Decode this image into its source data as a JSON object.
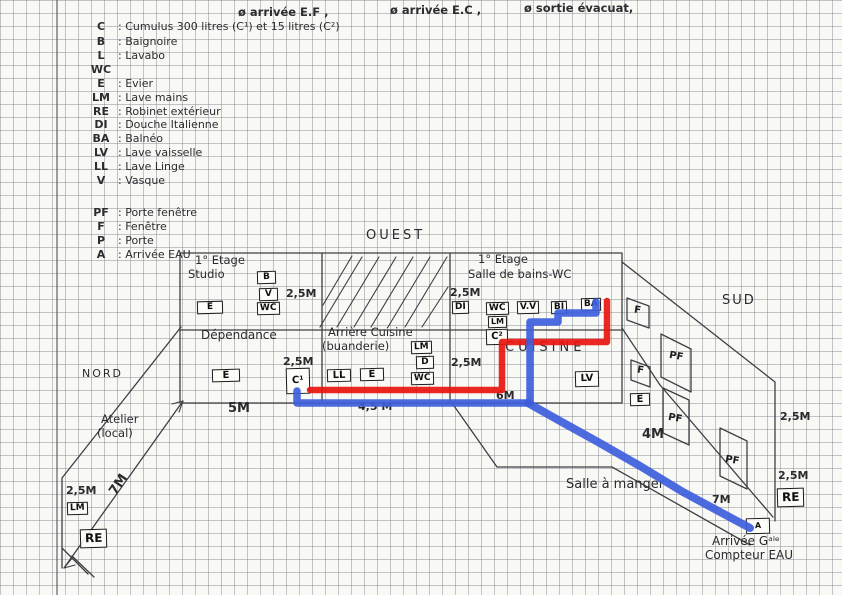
{
  "header": {
    "ef": "ø arrivée E.F ,",
    "ec": "ø arrivée E.C ,",
    "evac": "ø sortie évacuat,"
  },
  "legend": {
    "items": [
      {
        "k": "C",
        "d": ": Cumulus 300 litres (C¹) et 15 litres (C²)"
      },
      {
        "k": "B",
        "d": ": Baignoire"
      },
      {
        "k": "L",
        "d": ": Lavabo"
      },
      {
        "k": "WC",
        "d": ""
      },
      {
        "k": "E",
        "d": ": Evier"
      },
      {
        "k": "LM",
        "d": ": Lave mains"
      },
      {
        "k": "RE",
        "d": ": Robinet extérieur"
      },
      {
        "k": "DI",
        "d": ": Douche Italienne"
      },
      {
        "k": "BA",
        "d": ": Balnéo"
      },
      {
        "k": "LV",
        "d": ": Lave vaisselle"
      },
      {
        "k": "LL",
        "d": ": Lave Linge"
      },
      {
        "k": "V",
        "d": ": Vasque"
      }
    ],
    "items2": [
      {
        "k": "PF",
        "d": ": Porte fenêtre"
      },
      {
        "k": "F",
        "d": ": Fenêtre"
      },
      {
        "k": "P",
        "d": ": Porte"
      },
      {
        "k": "A",
        "d": ": Arrivée EAU"
      }
    ]
  },
  "orientation": {
    "west": "OUEST",
    "north": "NORD",
    "south": "SUD"
  },
  "rooms": {
    "studio_floor": "1° Etage",
    "studio": "Studio",
    "bath_floor": "1° Etage",
    "bath": "Salle de bains-WC",
    "dependance": "Dépendance",
    "arriere_cuisine": "Arrière Cuisine",
    "buanderie": "(buanderie)",
    "cuisine": "CUISINE",
    "salle_a_manger": "Salle à manger",
    "atelier": "Atelier",
    "atelier2": "(local)"
  },
  "dimensions": {
    "studio_h": "2,5M",
    "bath_h": "2,5M",
    "c1_h": "2,5M",
    "douche_h": "2,5M",
    "dependance_w": "5M",
    "arriere_w": "4,5 M",
    "cuisine_w": "6M",
    "salle_w": "4M",
    "wall_right_a": "2,5M",
    "wall_right_b": "2,5M",
    "atelier_h": "2,5M",
    "atelier_l": "7M",
    "salle_l": "7M"
  },
  "fixtures": {
    "studio_b": "B",
    "studio_v": "V",
    "studio_wc": "WC",
    "studio_e": "E",
    "dep_e": "E",
    "c1": "C¹",
    "ll": "LL",
    "ac_e": "E",
    "ac_lm": "LM",
    "ac_d": "D",
    "ac_wc": "WC",
    "bath_di": "DI",
    "bath_wc": "WC",
    "bath_vv": "V.V",
    "bath_bi": "BI",
    "bath_ba": "BA",
    "bath_lm": "LM",
    "c2": "C²",
    "lv": "LV",
    "wall_e": "E",
    "re_right": "RE",
    "lm_left": "LM",
    "re_left": "RE",
    "arrival_a": "A"
  },
  "windows": {
    "f1": "F",
    "pf1": "PF",
    "f2": "F",
    "pf2": "PF",
    "pf3": "PF"
  },
  "arrival": {
    "line1": "Arrivée Gᵃˡᵉ",
    "line2": "Compteur EAU"
  },
  "pipes": {
    "hot_color": "#e8150d",
    "cold_color": "#3d5edb",
    "pencil_color": "#3f3f42"
  }
}
